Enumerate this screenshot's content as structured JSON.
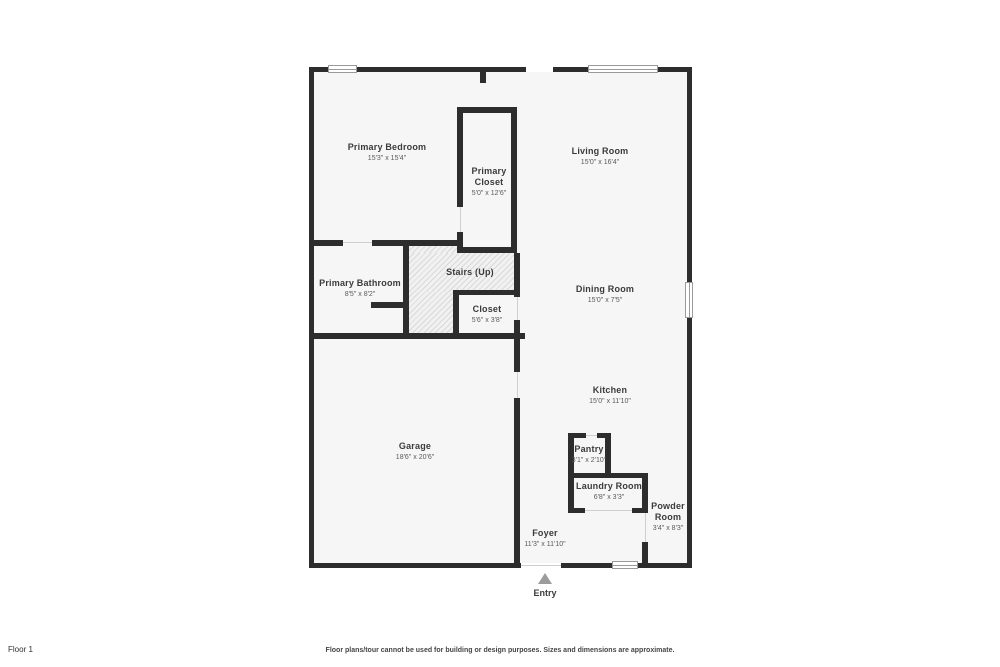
{
  "floor_label": "Floor 1",
  "disclaimer": "Floor plans/tour cannot be used for building or design purposes. Sizes and dimensions are approximate.",
  "entry": {
    "label": "Entry"
  },
  "rooms": [
    {
      "id": "primary-bedroom",
      "name": "Primary Bedroom",
      "dims": "15'3\" x 15'4\""
    },
    {
      "id": "primary-closet",
      "name": "Primary Closet",
      "dims": "5'0\" x 12'6\""
    },
    {
      "id": "living-room",
      "name": "Living Room",
      "dims": "15'0\" x 16'4\""
    },
    {
      "id": "primary-bathroom",
      "name": "Primary Bathroom",
      "dims": "8'5\" x 8'2\""
    },
    {
      "id": "stairs",
      "name": "Stairs (Up)",
      "dims": ""
    },
    {
      "id": "closet",
      "name": "Closet",
      "dims": "5'6\" x 3'8\""
    },
    {
      "id": "dining-room",
      "name": "Dining Room",
      "dims": "15'0\" x 7'5\""
    },
    {
      "id": "kitchen",
      "name": "Kitchen",
      "dims": "15'0\" x 11'10\""
    },
    {
      "id": "garage",
      "name": "Garage",
      "dims": "18'6\" x 20'6\""
    },
    {
      "id": "pantry",
      "name": "Pantry",
      "dims": "3'1\" x 2'10\""
    },
    {
      "id": "laundry-room",
      "name": "Laundry Room",
      "dims": "6'8\" x 3'3\""
    },
    {
      "id": "powder-room",
      "name": "Powder Room",
      "dims": "3'4\" x 8'3\""
    },
    {
      "id": "foyer",
      "name": "Foyer",
      "dims": "11'3\" x 11'10\""
    }
  ]
}
